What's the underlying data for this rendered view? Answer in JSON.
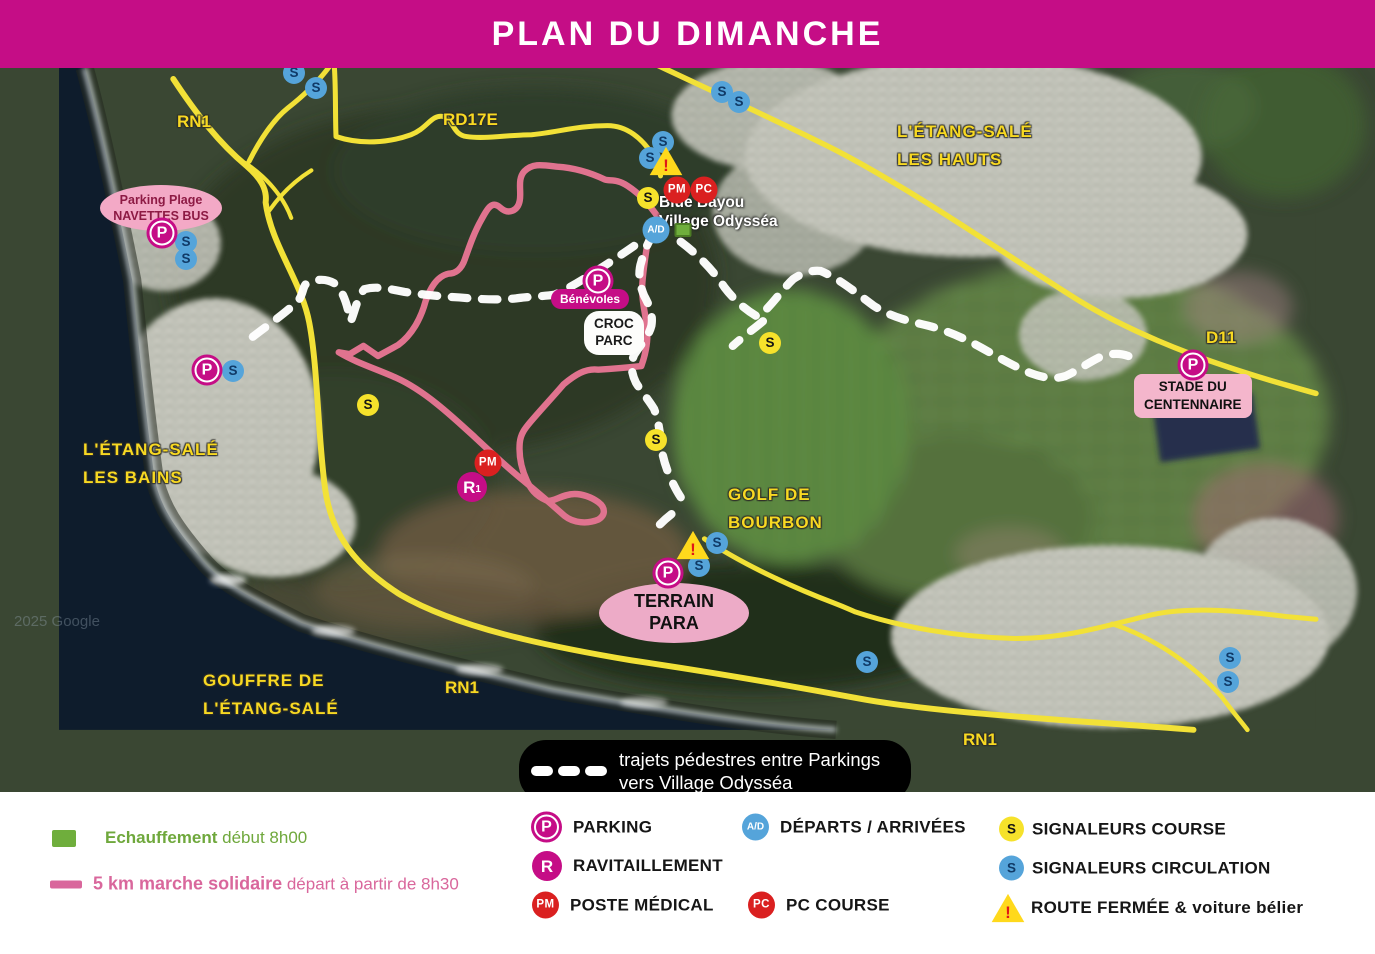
{
  "header": {
    "title": "PLAN DU DIMANCHE",
    "bg_color": "#c50d86"
  },
  "map": {
    "watermark": "2025 Google",
    "colors": {
      "road_yellow": "#f2e137",
      "route_pink": "#e0738f",
      "path_white": "#ffffff",
      "marker_magenta": "#c50d86",
      "marker_red": "#da2020",
      "marker_blue": "#55a4da",
      "marker_yellow": "#f6e22b",
      "ocean": "#0e1c2c"
    },
    "marker_glyphs": {
      "p": "P",
      "r": "R",
      "r_sub": "1",
      "pm": "PM",
      "pc": "PC",
      "ad": "A/D",
      "sy": "S",
      "sb": "S",
      "warn": "!",
      "green": ""
    },
    "marker_names": {
      "p": "parking-marker",
      "r": "ravitaillement-marker",
      "pm": "poste-medical-marker",
      "pc": "pc-course-marker",
      "ad": "departs-arrivees-marker",
      "sy": "signaleur-course-marker",
      "sb": "signaleur-circulation-marker",
      "warn": "route-fermee-warning-icon",
      "green": "echauffement-square"
    },
    "markers": [
      {
        "t": "sb",
        "x": 294,
        "y": 73
      },
      {
        "t": "sb",
        "x": 316,
        "y": 88
      },
      {
        "t": "sb",
        "x": 722,
        "y": 92
      },
      {
        "t": "sb",
        "x": 739,
        "y": 102
      },
      {
        "t": "sb",
        "x": 663,
        "y": 142
      },
      {
        "t": "sb",
        "x": 650,
        "y": 158
      },
      {
        "t": "sb",
        "x": 186,
        "y": 242
      },
      {
        "t": "sb",
        "x": 186,
        "y": 259
      },
      {
        "t": "sb",
        "x": 233,
        "y": 371
      },
      {
        "t": "sb",
        "x": 717,
        "y": 543
      },
      {
        "t": "sb",
        "x": 699,
        "y": 566
      },
      {
        "t": "sb",
        "x": 867,
        "y": 662
      },
      {
        "t": "sb",
        "x": 1230,
        "y": 658
      },
      {
        "t": "sb",
        "x": 1228,
        "y": 682
      },
      {
        "t": "sy",
        "x": 648,
        "y": 198
      },
      {
        "t": "sy",
        "x": 770,
        "y": 343
      },
      {
        "t": "sy",
        "x": 368,
        "y": 405
      },
      {
        "t": "sy",
        "x": 656,
        "y": 440
      },
      {
        "t": "warn",
        "x": 666,
        "y": 161
      },
      {
        "t": "warn",
        "x": 693,
        "y": 545
      },
      {
        "t": "p",
        "x": 162,
        "y": 233
      },
      {
        "t": "p",
        "x": 598,
        "y": 281
      },
      {
        "t": "p",
        "x": 207,
        "y": 370
      },
      {
        "t": "p",
        "x": 668,
        "y": 573
      },
      {
        "t": "p",
        "x": 1193,
        "y": 365
      },
      {
        "t": "r",
        "x": 472,
        "y": 487
      },
      {
        "t": "pm",
        "x": 677,
        "y": 190
      },
      {
        "t": "pm",
        "x": 488,
        "y": 463
      },
      {
        "t": "pc",
        "x": 704,
        "y": 190
      },
      {
        "t": "ad",
        "x": 656,
        "y": 230
      },
      {
        "t": "green",
        "x": 683,
        "y": 230
      }
    ],
    "road_labels": [
      {
        "text": "RN1",
        "x": 177,
        "y": 112
      },
      {
        "text": "RD17E",
        "x": 443,
        "y": 110
      },
      {
        "text": "D11",
        "x": 1206,
        "y": 328
      },
      {
        "text": "RN1",
        "x": 445,
        "y": 678
      },
      {
        "text": "RN1",
        "x": 963,
        "y": 730
      }
    ],
    "area_labels": [
      {
        "id": "etang-sale-les-hauts",
        "lines": [
          "L'ÉTANG-SALÉ",
          "LES HAUTS"
        ],
        "x": 897,
        "y": 118
      },
      {
        "id": "etang-sale-les-bains",
        "lines": [
          "L'ÉTANG-SALÉ",
          "LES BAINS"
        ],
        "x": 83,
        "y": 436
      },
      {
        "id": "golf-de-bourbon",
        "lines": [
          "GOLF DE",
          "BOURBON"
        ],
        "x": 728,
        "y": 481
      },
      {
        "id": "gouffre-etang-sale",
        "lines": [
          "GOUFFRE DE",
          "L'ÉTANG-SALÉ"
        ],
        "x": 203,
        "y": 667
      }
    ],
    "poi": {
      "parking_plage": {
        "line1": "Parking Plage",
        "line2": "NAVETTES BUS"
      },
      "blue_bayou": {
        "line1": "Blue Bayou",
        "line2": "Village Odysséa"
      },
      "benevoles": "Bénévoles",
      "croc_parc": {
        "line1": "CROC",
        "line2": "PARC"
      },
      "terrain_para": {
        "line1": "TERRAIN",
        "line2": "PARA"
      },
      "stade": {
        "line1": "STADE DU",
        "line2": "CENTENNAIRE"
      }
    },
    "note": {
      "line1": "trajets pédestres entre Parkings",
      "line2": "vers Village Odysséa"
    }
  },
  "legend": {
    "echauffement_bold": "Echauffement",
    "echauffement_rest": " début 8h00",
    "marche_bold": "5 km marche solidaire",
    "marche_rest": " départ à partir de 8h30",
    "parking": "PARKING",
    "ravitaillement": "RAVITAILLEMENT",
    "poste_medical": "POSTE MÉDICAL",
    "departs_arrivees": "DÉPARTS / ARRIVÉES",
    "pc_course": "PC COURSE",
    "signaleurs_course": "SIGNALEURS COURSE",
    "signaleurs_circulation": "SIGNALEURS CIRCULATION",
    "route_fermee": "ROUTE FERMÉE & voiture bélier"
  }
}
